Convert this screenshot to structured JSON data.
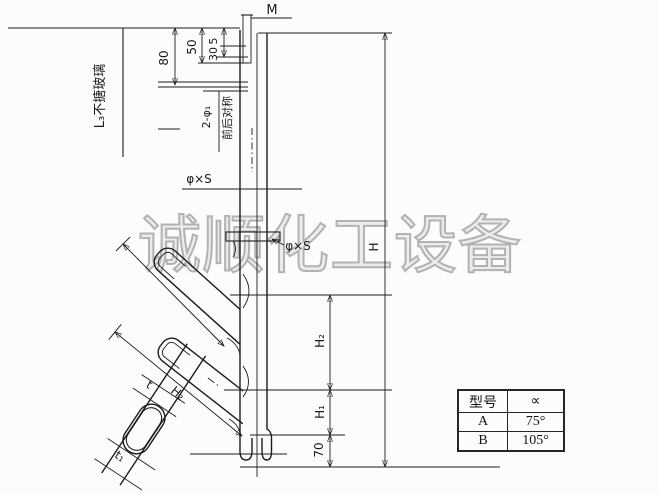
{
  "watermark": "诚顺化工设备",
  "drawing": {
    "thread_label": "M",
    "left_note": "L₃不搪玻璃",
    "dims_top": {
      "d80": "80",
      "d50": "50",
      "d5": "5",
      "d30": "30"
    },
    "holes_label": "2-φ₁",
    "holes_note": "前后对称",
    "tube_spec_main": "φ×S",
    "tube_spec_branch": "φ×S",
    "dims_right": {
      "H": "H",
      "H2": "H₂",
      "H1": "H₁",
      "d70": "70"
    },
    "dims_branch": {
      "H2": "H₂",
      "t": "t",
      "t1": "t₁"
    }
  },
  "table": {
    "headers": [
      "型号",
      "∝"
    ],
    "rows": [
      [
        "A",
        "75°"
      ],
      [
        "B",
        "105°"
      ]
    ]
  },
  "colors": {
    "line": "#1c1c1c",
    "watermark": "#b2b2b2",
    "paper": "#fcfcfc"
  }
}
